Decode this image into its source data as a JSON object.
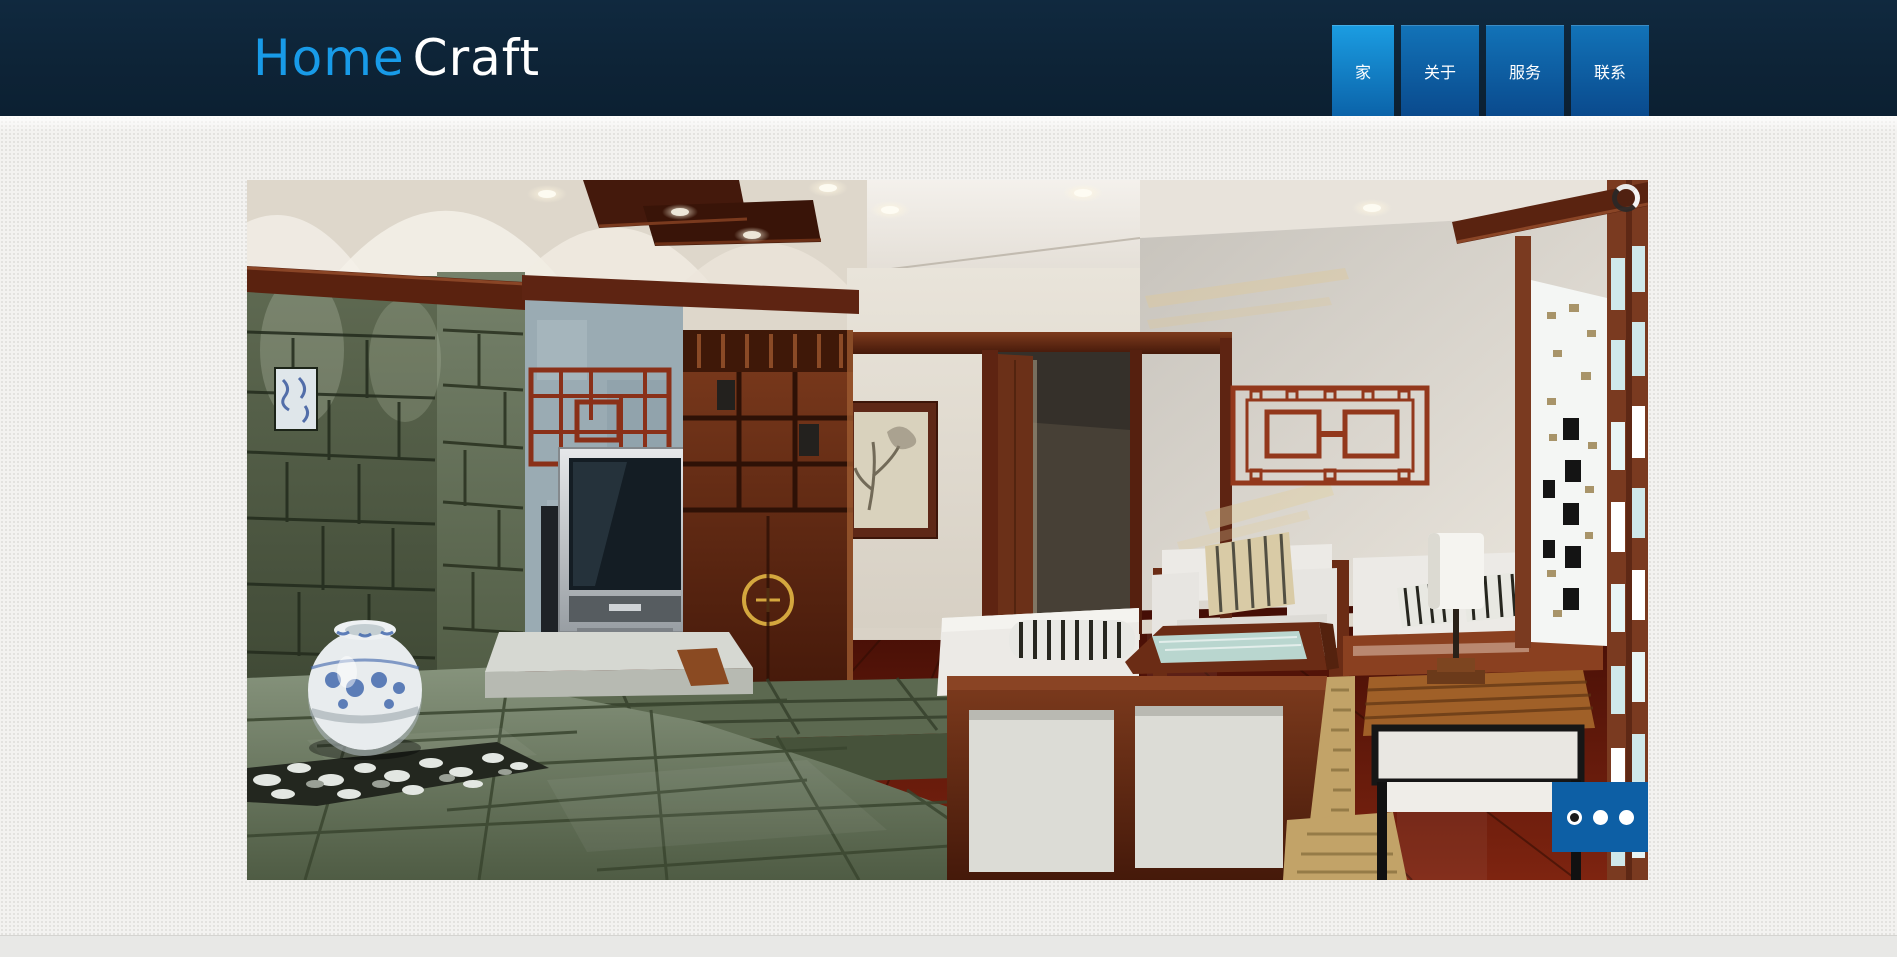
{
  "window": {
    "title": "Home Craft"
  },
  "header": {
    "logo": {
      "primary": "Home",
      "secondary": "Craft"
    }
  },
  "nav": {
    "items": [
      {
        "label": "家",
        "active": true
      },
      {
        "label": "关于",
        "active": false
      },
      {
        "label": "服务",
        "active": false
      },
      {
        "label": "联系",
        "active": false
      }
    ]
  },
  "slideshow": {
    "description": "Chinese-style living room interior rendering: green stone feature wall with porcelain vase and pebbles, TV unit, rosewood cabinet, framed ink painting, doorway, red lattice wall ornament, white sofas with striped cushions, glass coffee table, side table with lamp, lattice window screen",
    "pager": {
      "count": 3,
      "active_index": 0,
      "dots": [
        {
          "active": true
        },
        {
          "active": false
        },
        {
          "active": false
        }
      ]
    },
    "loading_icon": "loading-spinner"
  },
  "colors": {
    "header_bg": "#0d2336",
    "logo_primary": "#189be8",
    "logo_secondary": "#ffffff",
    "nav_active_top": "#1b9de2",
    "nav_active_bottom": "#0b63a9",
    "nav_item_top": "#1273b8",
    "nav_item_bottom": "#0a4a8d",
    "pager_bg": "#0d5fa5",
    "pager_dot": "#ffffff",
    "pager_dot_active_center": "#1b1b1b",
    "page_bg": "#f3f2f0",
    "footer_bg": "#e8e8e6"
  }
}
